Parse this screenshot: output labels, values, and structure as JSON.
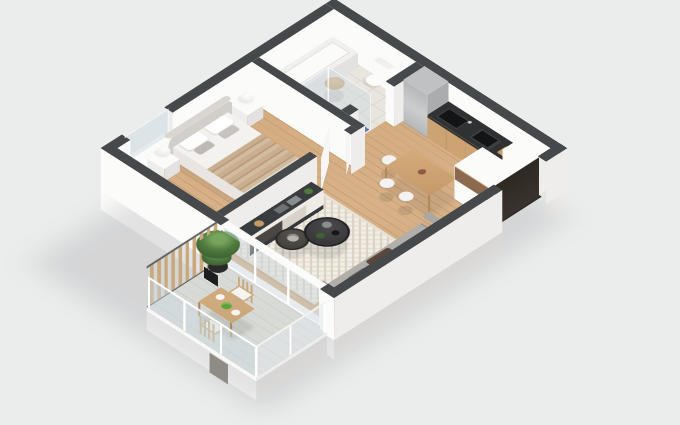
{
  "scene": {
    "title": "Isometric 3D floor plan render — one-bedroom apartment with balcony",
    "style": "photorealistic architectural visualization on light gray backdrop",
    "view": "cut-away walls with dark gray tops, viewed from above at ~50 degrees"
  },
  "colors": {
    "bg": "#ebecec",
    "wallTop": "#46494b",
    "white": "#fbfbfa",
    "shade": "#eeedeb",
    "shade2": "#e3e2e0",
    "wood": "#d2a97c",
    "woodLine": "#c49e72",
    "tile": "#e9e5df",
    "tileLine": "#dbd6ce",
    "mosaic": "#4a6e9e",
    "balc": "#d8dad6",
    "balcLine": "#cbcec9",
    "rugBase": "#f2ede5",
    "rugPat": "#d9d1c3",
    "sofa": "#b2aeaa",
    "sofaBack": "#a09c98",
    "sofaDark": "#8f8b87",
    "throwBrown": "#5c483a",
    "linen": "#f4f2ee",
    "blanket": "#c9af90",
    "blanketLine": "#b99c7d",
    "headboard": "#d9d6d1",
    "counterTop": "#2f3132",
    "cooktop": "#131415",
    "cabinetWood": "#cda374",
    "fridge": "#bfc1c3",
    "fridgeSide": "#aaacae",
    "doorDark": "#2e2823",
    "glass": "rgba(205,218,224,0.45)",
    "fence": "#c9a87b",
    "fenceFrame": "#5f6264",
    "plant": "#4e7a3e",
    "plantDark": "#3c612f",
    "pot": "#2a2a2a",
    "woodFurn": "#c49a6a",
    "stoolSeat": "#f4f3f1"
  },
  "rooms": [
    {
      "id": "bathroom",
      "position": "north corner",
      "features": [
        "bathtub",
        "toilet",
        "round-wooden-stool",
        "walk-in-shower",
        "blue-mosaic-shower-floor",
        "glass-partition",
        "tiled-floor"
      ]
    },
    {
      "id": "bedroom",
      "position": "west corner",
      "features": [
        "double-bed",
        "white-duvet",
        "beige-striped-blanket",
        "upholstered-headboard",
        "two-white-nightstands",
        "two-sphere-lamps",
        "window-in-northwest-wall",
        "open-white-door"
      ]
    },
    {
      "id": "kitchen",
      "position": "along northeast wall",
      "features": [
        "tall-gray-fridge",
        "dark-countertop",
        "inset-sink",
        "black-cooktop",
        "wood-drawer-fronts",
        "tall-white-cabinet"
      ]
    },
    {
      "id": "dining",
      "position": "center-east",
      "features": [
        "rectangular-wood-table",
        "three-white-stools",
        "flower-vase"
      ]
    },
    {
      "id": "living",
      "position": "south corner",
      "features": [
        "gray-three-seat-sofa",
        "brown-throw-pillow",
        "white-chevron-rug",
        "two-round-black-coffee-tables",
        "dark-top-sideboard",
        "books",
        "decor",
        "small-side-table",
        "potted-plant"
      ]
    },
    {
      "id": "entry",
      "position": "east corner",
      "features": [
        "open-dark-front-door",
        "white-wardrobe-with-open-shelf"
      ]
    },
    {
      "id": "balcony",
      "position": "southwest, outside living room",
      "features": [
        "glass-railing-white-frame",
        "wood-slat-privacy-screen",
        "large-potted-tree",
        "wood-table",
        "two-wood-chairs-with-white-cushions",
        "green-fruit-bowl",
        "glass-sliding-door"
      ]
    }
  ]
}
